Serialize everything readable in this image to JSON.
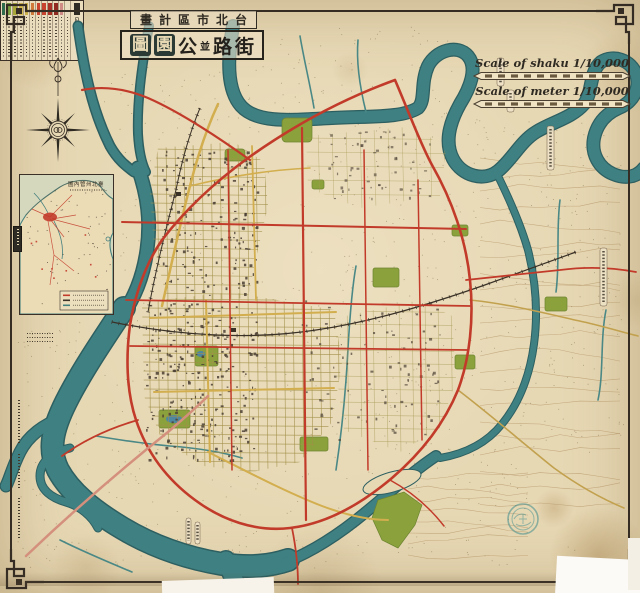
{
  "page": {
    "width": 640,
    "height": 593,
    "kind": "historical-city-plan-map"
  },
  "title": {
    "top_line_display": "畫計區市北台",
    "main_line_chars": [
      "圖",
      "園",
      "公",
      "並",
      "路",
      "街"
    ],
    "main_line_styles": [
      "seal",
      "seal",
      "plain",
      "small",
      "plain",
      "plain"
    ]
  },
  "scalebars": [
    {
      "label": "Scale of shaku 1/10,000"
    },
    {
      "label": "Scale of meter 1/10,000"
    }
  ],
  "inset": {
    "title_display": "圖內管州北臺"
  },
  "legend": {
    "title_display": "凡例",
    "items": [
      {
        "name": "legend-swatch-darkgreen",
        "color": "#2f6b4d"
      },
      {
        "name": "legend-swatch-green",
        "color": "#7aa13f"
      },
      {
        "name": "legend-swatch-olive",
        "color": "#a9a73a"
      },
      {
        "name": "legend-swatch-yellow",
        "color": "#d6bd52"
      },
      {
        "name": "legend-swatch-yellow2",
        "color": "#cdb14a"
      },
      {
        "name": "legend-swatch-orange",
        "color": "#cf7a3a"
      },
      {
        "name": "legend-swatch-red",
        "color": "#c8442e"
      },
      {
        "name": "legend-swatch-red2",
        "color": "#c8442e"
      },
      {
        "name": "legend-swatch-darkred",
        "color": "#a93226"
      },
      {
        "name": "legend-swatch-maroon",
        "color": "#8f2b20"
      },
      {
        "name": "legend-swatch-pink",
        "color": "#d08a86"
      },
      {
        "name": "legend-swatch-blank",
        "color": "#e7dcc2"
      }
    ]
  },
  "colors": {
    "paper": "#e7d8b4",
    "river": "#3f8082",
    "river_casing": "#2d5f61",
    "road_red": "#c23b2a",
    "road_salmon": "#d4907c",
    "road_yellow": "#d2ae4e",
    "park": "#8ba23c",
    "building": "#4a4034",
    "contour": "#b79a6d",
    "ink": "#3a3027",
    "pond": "#4f86a0",
    "stamp": "#3e8d8d"
  }
}
